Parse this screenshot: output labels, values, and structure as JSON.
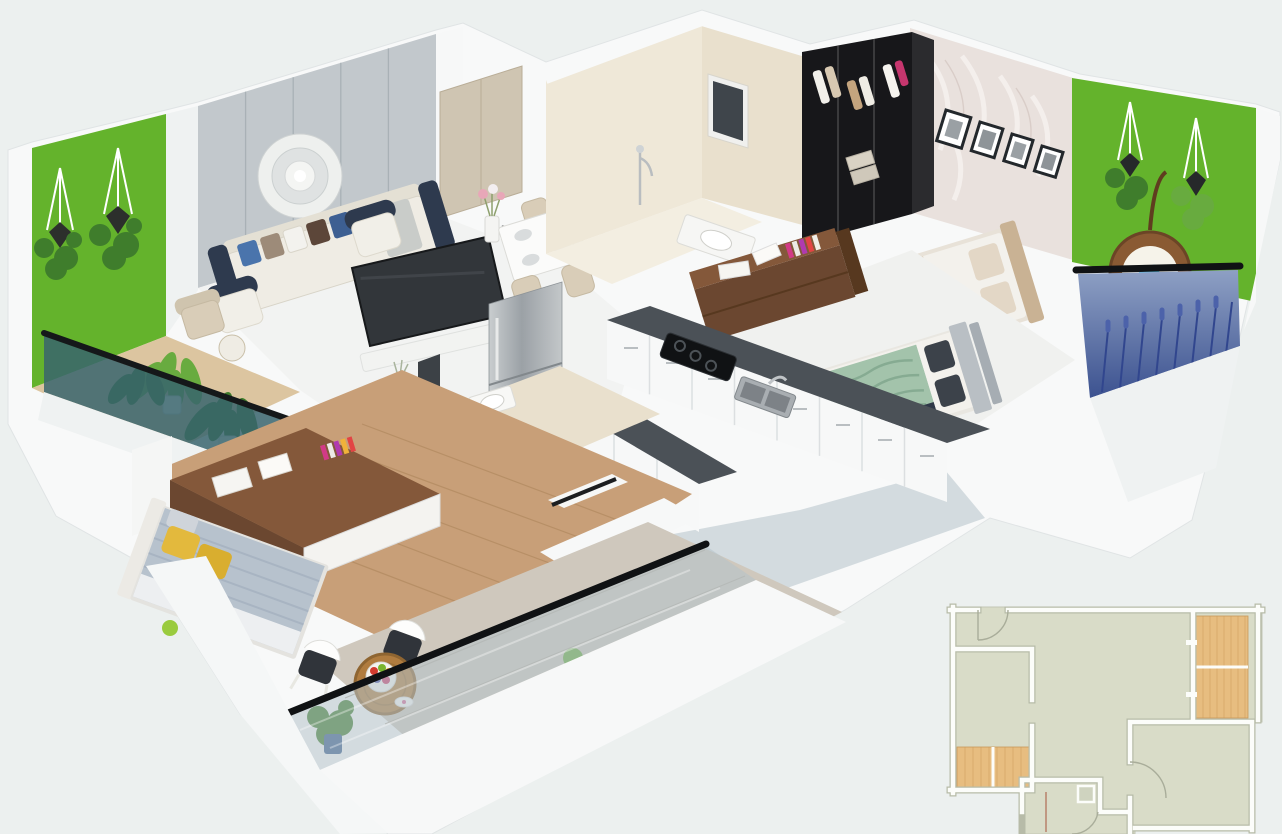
{
  "title": "3D isometric floor plan render of a 2 BHK apartment",
  "scene": {
    "view": "3d-isometric-cutaway-render",
    "no_visible_text": true,
    "rooms": [
      {
        "name": "living-room",
        "items": [
          "grey panelled accent wall",
          "round plaster wall medallion",
          "white three-seater sofa with blue, taupe and brown cushions",
          "two armchairs with navy backs",
          "flat-screen TV",
          "banana-leaf plants"
        ]
      },
      {
        "name": "dining-area",
        "items": [
          "white dining table",
          "four beige chairs",
          "wine bottles",
          "flower vase",
          "place settings"
        ]
      },
      {
        "name": "kitchen",
        "items": [
          "two parallel dark granite counters",
          "white drawer cabinets",
          "black hob",
          "double-bowl sink with faucet",
          "stainless-steel refrigerator"
        ]
      },
      {
        "name": "bathroom-1",
        "items": [
          "beige tiled walls",
          "dark window",
          "hand shower",
          "washbasin"
        ]
      },
      {
        "name": "bathroom-2",
        "items": [
          "beige tiled walls",
          "washbasin",
          "dark mirror panel",
          "aqua vase"
        ]
      },
      {
        "name": "master-bedroom",
        "items": [
          "black open wardrobe with hanging clothes",
          "palm-feather wallpaper wall",
          "four framed pictures",
          "double bed with beige bedding",
          "grey upholstered headboard bed with sage-green blanket",
          "walnut study unit"
        ]
      },
      {
        "name": "bedroom-2",
        "items": [
          "wooden floor",
          "double bed with grey striped duvet and yellow pillows",
          "walnut wardrobe-study unit with colourful books"
        ]
      },
      {
        "name": "balcony-left",
        "items": [
          "artificial grass wall",
          "two macrame hanging planters",
          "beige lounge chair",
          "round side table",
          "potted plants",
          "teal glass railing with black handrail"
        ]
      },
      {
        "name": "balcony-right",
        "items": [
          "artificial grass wall",
          "two macrame hanging planters",
          "rattan hanging egg chair with blue cushions",
          "lavender-printed glass railing with black handrail"
        ]
      },
      {
        "name": "balcony-bottom",
        "items": [
          "two outdoor chairs with dark cushions",
          "round wooden table with fruit platter",
          "potted plants",
          "frosted glass railing with black handrail"
        ]
      }
    ],
    "minimap": {
      "type": "2d-floor-plan",
      "position": "bottom-right",
      "cropped_at": "bottom edge of image",
      "room_fill": "sage grey-green",
      "balcony_fill": "wood tan",
      "features": [
        "entry door arc top-left",
        "left room with balcony",
        "large central living area",
        "right-top balcony",
        "bottom-right bedroom with door arc",
        "small bathroom with door arc"
      ]
    }
  },
  "colors": {
    "bg": "#ecf0ef",
    "wall-white": "#f8f9f9",
    "wall-shade": "#ccd6da",
    "grey-wall": "#c2c8cc",
    "grey-wall-line": "#a9b1b6",
    "cream-wall": "#efe8d8",
    "cream-wall-dark": "#e9e0cd",
    "grass-green": "#64b32c",
    "plant-green": "#3f7d2c",
    "plant-light": "#68ab3f",
    "wood-floor": "#c89f78",
    "wood-floor-light": "#dcc5a0",
    "walnut": "#6b4730",
    "walnut-light": "#84583a",
    "counter-dark": "#4b5157",
    "steel-light": "#c8ccce",
    "steel-dark": "#9aa0a4",
    "sofa-cream": "#efece4",
    "navy": "#2e3a4e",
    "pillow-blue": "#4a74ac",
    "pillow-taupe": "#9d8b79",
    "pillow-brown": "#5c4639",
    "tv-screen": "#32363a",
    "bed-white": "#f3f1ec",
    "bed-beige": "#cbb9a5",
    "sage-blanket": "#a3c3ab",
    "pillow-dark": "#3c424a",
    "duvet-grey": "#b7c2cd",
    "pillow-yellow": "#e3b93d",
    "wardrobe-black": "#17171a",
    "wallpaper-blush": "#e9e1dd",
    "frame-dark": "#23282c",
    "glass-teal": "#38646d",
    "glass-lavender": "#5a72a2",
    "glass-light": "#b5c2ca",
    "rattan": "#8a5a33",
    "cushion-sky": "#5bc8f0",
    "chair-beige": "#d9cdb8",
    "chair-dark": "#30343a",
    "table-wood": "#b07c3f",
    "door-tan": "#cfc5b2",
    "plan-room": "#d9dcc8",
    "plan-wood": "#e7bd80",
    "plan-wood-line": "#c9995a"
  }
}
